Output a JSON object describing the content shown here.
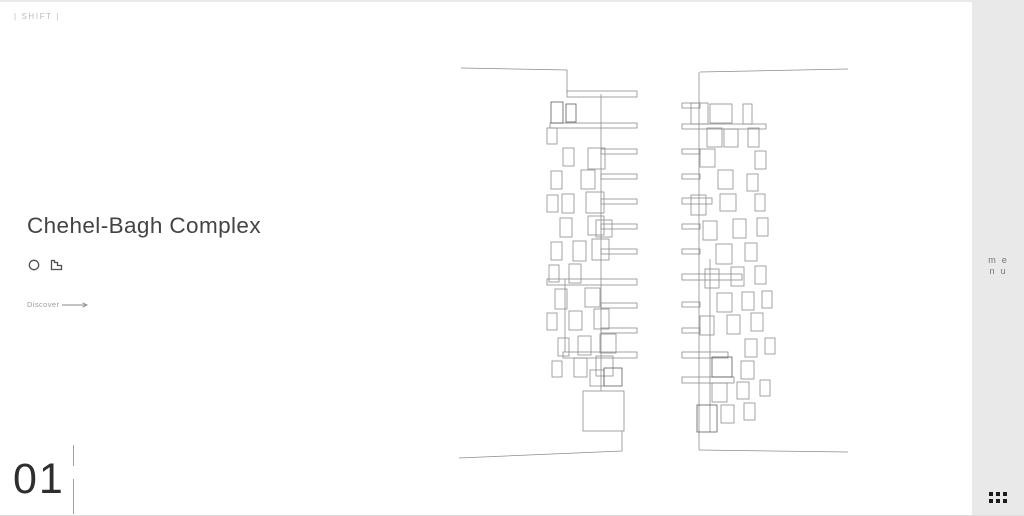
{
  "header": {
    "logo": "| SHIFT |"
  },
  "project": {
    "title": "Chehel-Bagh Complex",
    "discover_label": "Discover",
    "index": "01"
  },
  "sidebar": {
    "menu_line1": "me",
    "menu_line2": "nu",
    "bg": "#e9e9e9"
  },
  "colors": {
    "page_bg": "#ffffff",
    "top_border": "#e9e9e9",
    "bottom_border": "#dcdcdc",
    "logo_text": "#b6bcc6",
    "title_text": "#444447",
    "muted_text": "#9b9b9b",
    "index_text": "#2e2e2e",
    "menu_text": "#76767a",
    "grid_dot": "#1b1b1b",
    "icon_stroke": "#4f4f4f"
  },
  "drawing": {
    "viewbox": "450 55 410 410",
    "stroke": "#8d8d8d",
    "stroke_dark": "#5c5c5c",
    "polylines": [
      "461,66 567,68 567,91",
      "700,70 848,67",
      "601,92 601,389",
      "699,70 699,448",
      "622,429 622,449 459,456",
      "699,448 848,450",
      "565,277 565,350",
      "710,257 710,430"
    ],
    "rects": [
      [
        567,
        89,
        70,
        6
      ],
      [
        550,
        121,
        87,
        5
      ],
      [
        601,
        147,
        36,
        5
      ],
      [
        601,
        172,
        36,
        5
      ],
      [
        601,
        197,
        36,
        5
      ],
      [
        601,
        222,
        36,
        5
      ],
      [
        601,
        247,
        36,
        5
      ],
      [
        547,
        277,
        90,
        6
      ],
      [
        601,
        301,
        36,
        5
      ],
      [
        601,
        326,
        36,
        5
      ],
      [
        563,
        350,
        74,
        6
      ],
      [
        547,
        126,
        10,
        16
      ],
      [
        563,
        146,
        11,
        18
      ],
      [
        588,
        146,
        17,
        21
      ],
      [
        551,
        169,
        11,
        18
      ],
      [
        581,
        168,
        14,
        19
      ],
      [
        547,
        193,
        11,
        17
      ],
      [
        562,
        192,
        12,
        19
      ],
      [
        586,
        190,
        18,
        21
      ],
      [
        560,
        216,
        12,
        19
      ],
      [
        588,
        214,
        16,
        19
      ],
      [
        596,
        218,
        16,
        17
      ],
      [
        551,
        240,
        11,
        18
      ],
      [
        573,
        239,
        13,
        20
      ],
      [
        592,
        237,
        17,
        21
      ],
      [
        549,
        263,
        10,
        17
      ],
      [
        569,
        262,
        12,
        19
      ],
      [
        555,
        287,
        12,
        20
      ],
      [
        585,
        286,
        15,
        19
      ],
      [
        547,
        311,
        10,
        17
      ],
      [
        569,
        309,
        13,
        19
      ],
      [
        594,
        307,
        15,
        20
      ],
      [
        558,
        336,
        11,
        18
      ],
      [
        578,
        334,
        13,
        19
      ],
      [
        600,
        332,
        16,
        19
      ],
      [
        552,
        359,
        10,
        16
      ],
      [
        574,
        356,
        13,
        19
      ],
      [
        596,
        354,
        17,
        20
      ],
      [
        590,
        368,
        14,
        16
      ],
      [
        583,
        389,
        41,
        40
      ],
      [
        682,
        101,
        18,
        5
      ],
      [
        682,
        122,
        84,
        5
      ],
      [
        682,
        147,
        18,
        5
      ],
      [
        682,
        172,
        18,
        5
      ],
      [
        682,
        196,
        30,
        6
      ],
      [
        682,
        222,
        18,
        5
      ],
      [
        682,
        247,
        18,
        5
      ],
      [
        682,
        272,
        60,
        6
      ],
      [
        682,
        300,
        18,
        5
      ],
      [
        682,
        326,
        18,
        5
      ],
      [
        682,
        350,
        46,
        6
      ],
      [
        682,
        375,
        52,
        6
      ],
      [
        691,
        101,
        17,
        21
      ],
      [
        710,
        102,
        22,
        19
      ],
      [
        743,
        102,
        9,
        20
      ],
      [
        707,
        126,
        15,
        19
      ],
      [
        724,
        127,
        14,
        18
      ],
      [
        748,
        126,
        11,
        19
      ],
      [
        700,
        147,
        15,
        18
      ],
      [
        755,
        149,
        11,
        18
      ],
      [
        718,
        168,
        15,
        19
      ],
      [
        747,
        172,
        11,
        17
      ],
      [
        691,
        193,
        15,
        20
      ],
      [
        720,
        192,
        16,
        17
      ],
      [
        755,
        192,
        10,
        17
      ],
      [
        703,
        219,
        14,
        19
      ],
      [
        733,
        217,
        13,
        19
      ],
      [
        757,
        216,
        11,
        18
      ],
      [
        716,
        242,
        16,
        20
      ],
      [
        745,
        241,
        12,
        18
      ],
      [
        705,
        267,
        14,
        19
      ],
      [
        731,
        265,
        13,
        19
      ],
      [
        755,
        264,
        11,
        18
      ],
      [
        717,
        291,
        15,
        19
      ],
      [
        742,
        290,
        12,
        18
      ],
      [
        762,
        289,
        10,
        17
      ],
      [
        700,
        314,
        14,
        19
      ],
      [
        727,
        313,
        13,
        19
      ],
      [
        751,
        311,
        12,
        18
      ],
      [
        745,
        337,
        12,
        18
      ],
      [
        765,
        336,
        10,
        16
      ],
      [
        741,
        359,
        13,
        18
      ],
      [
        712,
        381,
        15,
        19
      ],
      [
        737,
        380,
        12,
        17
      ],
      [
        760,
        378,
        10,
        16
      ],
      [
        721,
        403,
        13,
        18
      ],
      [
        744,
        401,
        11,
        17
      ]
    ],
    "rects_dark": [
      [
        551,
        100,
        12,
        21
      ],
      [
        566,
        102,
        10,
        18
      ],
      [
        604,
        366,
        18,
        18
      ],
      [
        712,
        355,
        20,
        20
      ],
      [
        697,
        403,
        20,
        27
      ]
    ]
  }
}
